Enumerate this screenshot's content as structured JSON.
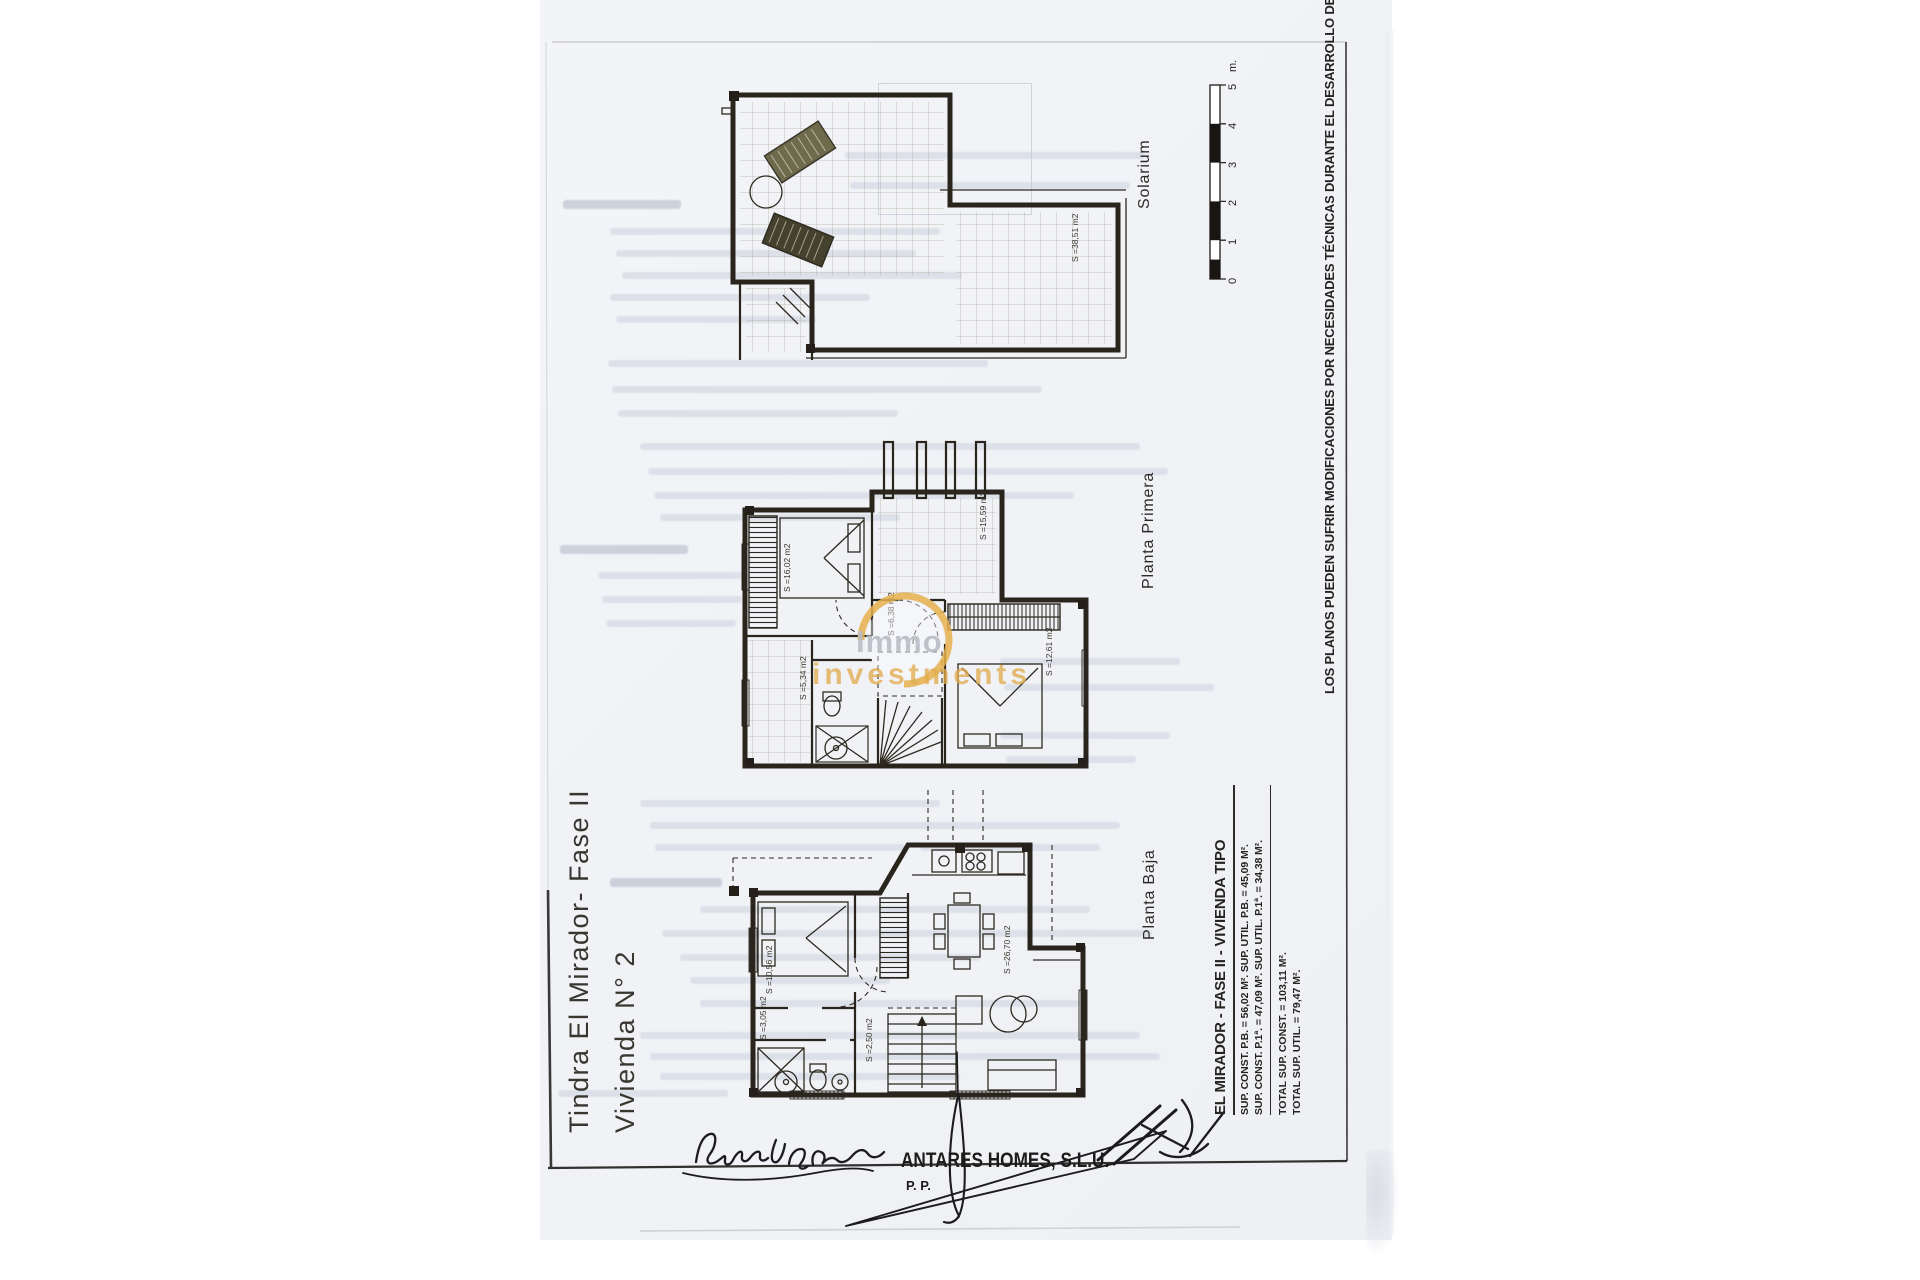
{
  "document": {
    "title_line1": "Tindra El Mirador- Fase II",
    "title_line2": "Vivienda N° 2",
    "disclaimer": "LOS PLANOS PUEDEN SUFRIR MODIFICACIONES POR NECESIDADES TÉCNICAS DURANTE EL DESARROLLO DE LA OBRA."
  },
  "plans": [
    {
      "label": "Solarium",
      "area_label": "S =38,51 m2"
    },
    {
      "label": "Planta Primera",
      "room_labels": [
        "S =16,02 m2",
        "S =15,59 m2",
        "S =12,61 m2",
        "S =5,34 m2",
        "S =6,38 m2"
      ]
    },
    {
      "label": "Planta Baja",
      "room_labels": [
        "S =10,56 m2",
        "S =26,70 m2",
        "S =3,05 m2",
        "S =2,50 m2"
      ]
    }
  ],
  "scale_bar": {
    "ticks": [
      "0",
      "1",
      "2",
      "3",
      "4",
      "5"
    ],
    "unit": "m."
  },
  "stats": {
    "heading": "EL MIRADOR - FASE II - VIVIENDA TIPO",
    "line1": "SUP. CONST. P.B. = 56,02 M². SUP. UTIL. P.B. = 45,09 M².",
    "line2": "SUP. CONST. P.1ª. = 47,09 M². SUP. UTIL. P.1ª. = 34,38 M².",
    "total1": "TOTAL SUP. CONST. = 103,11 M².",
    "total2": "TOTAL SUP. UTIL. = 79,47 M²."
  },
  "signature": {
    "company": "ANTARES HOMES, S.L.U.",
    "pp": "P. P."
  },
  "watermark": {
    "word1": "Immo",
    "word2": "investments",
    "ring_color": "#e8b14e"
  },
  "colors": {
    "paper": "#f2f3f6",
    "ink": "#29241c",
    "accent": "#e8b14e"
  }
}
